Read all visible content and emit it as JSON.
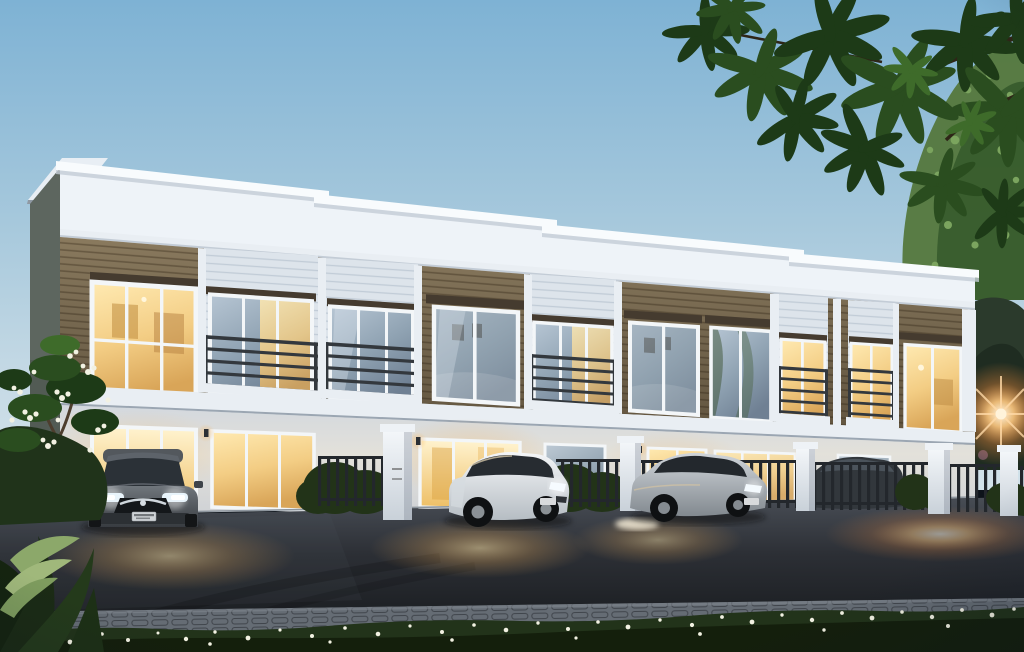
{
  "scene": {
    "type": "photorealistic-architectural-rendering",
    "time_of_day": "dusk",
    "subject": "Modern two-storey townhouse row with warm lit interiors, parked cars on a driveway, garden foreground and overhanging tree branches",
    "building": {
      "name": "townhouse-row",
      "floors": 2,
      "roof": "stepped white flat parapet with projecting cap slabs",
      "cladding": [
        "white render",
        "horizontal wood-grain siding"
      ],
      "features": [
        "protruding bay windows",
        "balconies with dark metal bar railings",
        "white floor slab band",
        "warm interior lighting",
        "wall sconces"
      ],
      "units_visible": 5
    },
    "vehicles": [
      {
        "name": "gray-sedan",
        "view": "front",
        "position": "left",
        "lights": "headlights reflecting white"
      },
      {
        "name": "white-hatchback",
        "view": "three-quarter front",
        "position": "center"
      },
      {
        "name": "silver-hatchback",
        "view": "three-quarter front",
        "position": "center-right"
      },
      {
        "name": "dark-car-behind-fence",
        "view": "silhouette",
        "position": "right, behind picket fence"
      }
    ],
    "frontage": [
      "white gate pillars",
      "dark metal picket fencing",
      "clipped hedges",
      "asphalt driveway with warm light pools",
      "cobblestone walkway band",
      "flowering ground-cover strip"
    ],
    "vegetation": [
      "plumeria shrub with white flowers (left)",
      "broad-leaf foreground plants (bottom-left)",
      "dark leaf canopy overhanging (top-right)",
      "soft green tree (right)",
      "dusk tree silhouettes behind fence (right)"
    ],
    "lighting": [
      "warm interior glow from windows and doors",
      "white headlight glints",
      "orange sun flare through trees at right",
      "lens flare dots"
    ]
  },
  "palette": {
    "sky_top": "#7eb2d4",
    "sky_mid": "#a6c8dc",
    "sky_horizon": "#d2e2ea",
    "parapet": "#eef3f8",
    "parapet_cap": "#f8fbfd",
    "parapet_shadow": "#c3ccd6",
    "wood": "#8a7a5e",
    "wood_dark": "#6b5f49",
    "siding": "#dde4eb",
    "slab": "#e9eef3",
    "wall": "#dfdfda",
    "wall_shade": "#c7ced6",
    "frame": "#f3f6f8",
    "railing": "#33383d",
    "fence": "#23272c",
    "hedge": "#223318",
    "leaf_dark": "#1d3a17",
    "leaf_mid": "#2a4d1f",
    "leaf_light": "#3e6b2a",
    "tree_soft": "#56793f",
    "tree_speckle": "#7aa35a",
    "dusk_tree": "#2b3a2c",
    "grass": "#2b4022",
    "grass_dark": "#141f0c",
    "flower": "#f2f1e2",
    "asphalt": "#3b4047",
    "asphalt_deep": "#202328",
    "paver": "#656c74",
    "glow": "#f6c87e",
    "glare": "#ffb266",
    "car_gray": "#565b60",
    "car_white": "#e9edf0",
    "car_silver": "#b5bbc1",
    "car_dark": "#32373c",
    "pillar": "#eef2f6",
    "shadow": "#0a0d11"
  }
}
